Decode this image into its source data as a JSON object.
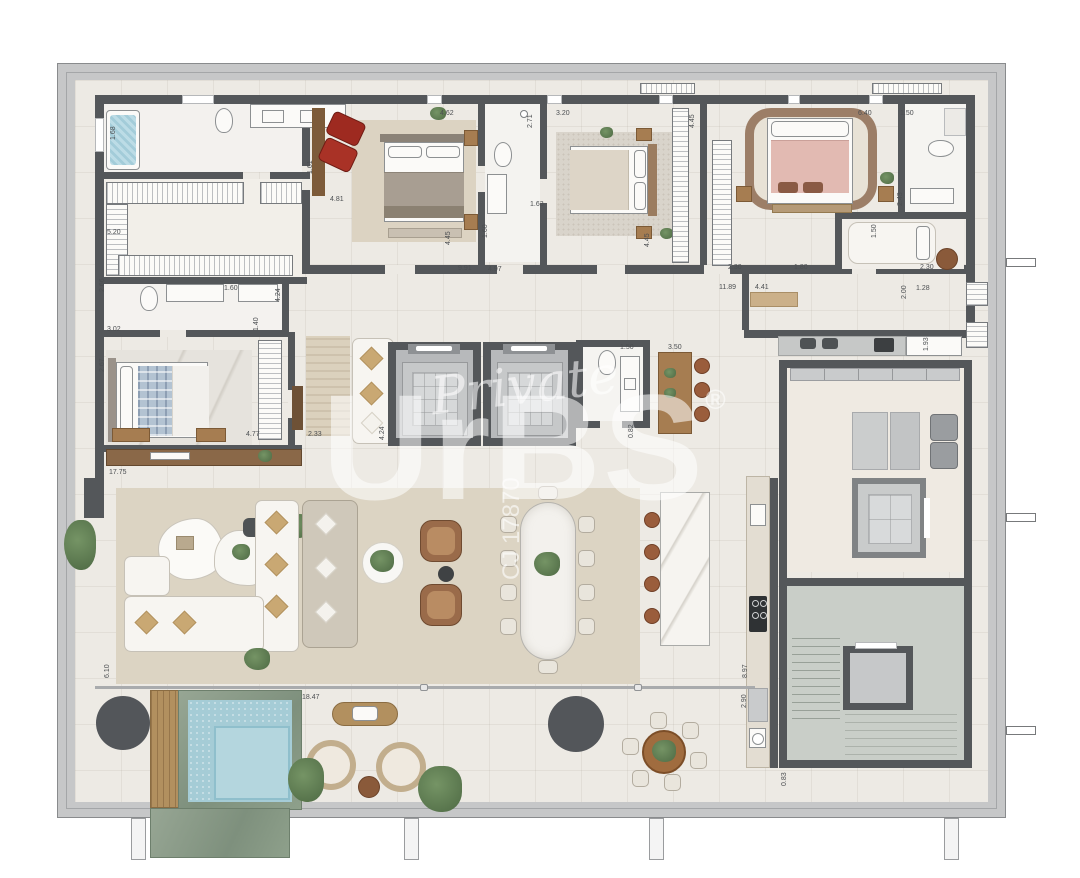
{
  "watermark": {
    "script": "Private",
    "brand": "UrBS",
    "registered": "®",
    "code": "CJ 17870"
  },
  "colors": {
    "wall": "#54575a",
    "floor": "#edeae4",
    "slab_band": "#c6c7c8",
    "living_rug": "#dcd4c3",
    "pool_water": "#a5ccd6",
    "pool_stone": "#87977f",
    "accent_chair_red": "#9e2a20",
    "master_bed_pink": "#e2bab2",
    "plaid_blue": "#b3c3d2",
    "wood": "#a67d51",
    "stair_floor": "#c9cec8"
  },
  "dimensions": [
    {
      "t": "1.68",
      "x": 110,
      "y": 140,
      "r": 1
    },
    {
      "t": "4.81",
      "x": 330,
      "y": 196,
      "r": 0
    },
    {
      "t": "5.20",
      "x": 107,
      "y": 229,
      "r": 0
    },
    {
      "t": "2.66",
      "x": 99,
      "y": 292,
      "r": 1
    },
    {
      "t": "4.62",
      "x": 440,
      "y": 110,
      "r": 0
    },
    {
      "t": "1.61",
      "x": 307,
      "y": 174,
      "r": 1
    },
    {
      "t": "4.45",
      "x": 445,
      "y": 245,
      "r": 1
    },
    {
      "t": "9.91",
      "x": 458,
      "y": 265,
      "r": 0
    },
    {
      "t": "4.97",
      "x": 488,
      "y": 266,
      "r": 0
    },
    {
      "t": "2.71",
      "x": 527,
      "y": 128,
      "r": 1
    },
    {
      "t": "1.63",
      "x": 530,
      "y": 201,
      "r": 0
    },
    {
      "t": "1.60",
      "x": 482,
      "y": 238,
      "r": 1
    },
    {
      "t": "3.20",
      "x": 556,
      "y": 110,
      "r": 0
    },
    {
      "t": "4.45",
      "x": 689,
      "y": 128,
      "r": 1
    },
    {
      "t": "4.45",
      "x": 644,
      "y": 247,
      "r": 1
    },
    {
      "t": "6.40",
      "x": 858,
      "y": 110,
      "r": 0
    },
    {
      "t": "1.50",
      "x": 900,
      "y": 110,
      "r": 0
    },
    {
      "t": "2.43",
      "x": 897,
      "y": 206,
      "r": 1
    },
    {
      "t": "1.50",
      "x": 871,
      "y": 238,
      "r": 1
    },
    {
      "t": "2.30",
      "x": 920,
      "y": 264,
      "r": 0
    },
    {
      "t": "1.80",
      "x": 794,
      "y": 264,
      "r": 0
    },
    {
      "t": "2.30",
      "x": 728,
      "y": 264,
      "r": 0
    },
    {
      "t": "11.89",
      "x": 719,
      "y": 284,
      "r": 0
    },
    {
      "t": "4.41",
      "x": 755,
      "y": 284,
      "r": 0
    },
    {
      "t": "2.00",
      "x": 901,
      "y": 299,
      "r": 1
    },
    {
      "t": "1.28",
      "x": 916,
      "y": 285,
      "r": 0
    },
    {
      "t": "1.93",
      "x": 923,
      "y": 351,
      "r": 1
    },
    {
      "t": "3.02",
      "x": 107,
      "y": 326,
      "r": 0
    },
    {
      "t": "1.60",
      "x": 224,
      "y": 285,
      "r": 0
    },
    {
      "t": "4.24",
      "x": 275,
      "y": 302,
      "r": 1
    },
    {
      "t": "1.40",
      "x": 253,
      "y": 331,
      "r": 1
    },
    {
      "t": "2.67",
      "x": 99,
      "y": 372,
      "r": 1
    },
    {
      "t": "4.77",
      "x": 246,
      "y": 431,
      "r": 0
    },
    {
      "t": "2.33",
      "x": 308,
      "y": 431,
      "r": 0
    },
    {
      "t": "4.24",
      "x": 379,
      "y": 440,
      "r": 1
    },
    {
      "t": "17.75",
      "x": 109,
      "y": 469,
      "r": 0
    },
    {
      "t": "1.50",
      "x": 620,
      "y": 344,
      "r": 0
    },
    {
      "t": "3.50",
      "x": 668,
      "y": 344,
      "r": 0
    },
    {
      "t": "0.82",
      "x": 628,
      "y": 438,
      "r": 1
    },
    {
      "t": "6.10",
      "x": 104,
      "y": 678,
      "r": 1
    },
    {
      "t": "18.47",
      "x": 302,
      "y": 694,
      "r": 0
    },
    {
      "t": "8.97",
      "x": 742,
      "y": 678,
      "r": 1
    },
    {
      "t": "2.90",
      "x": 741,
      "y": 708,
      "r": 1
    },
    {
      "t": "0.83",
      "x": 781,
      "y": 786,
      "r": 1
    }
  ]
}
